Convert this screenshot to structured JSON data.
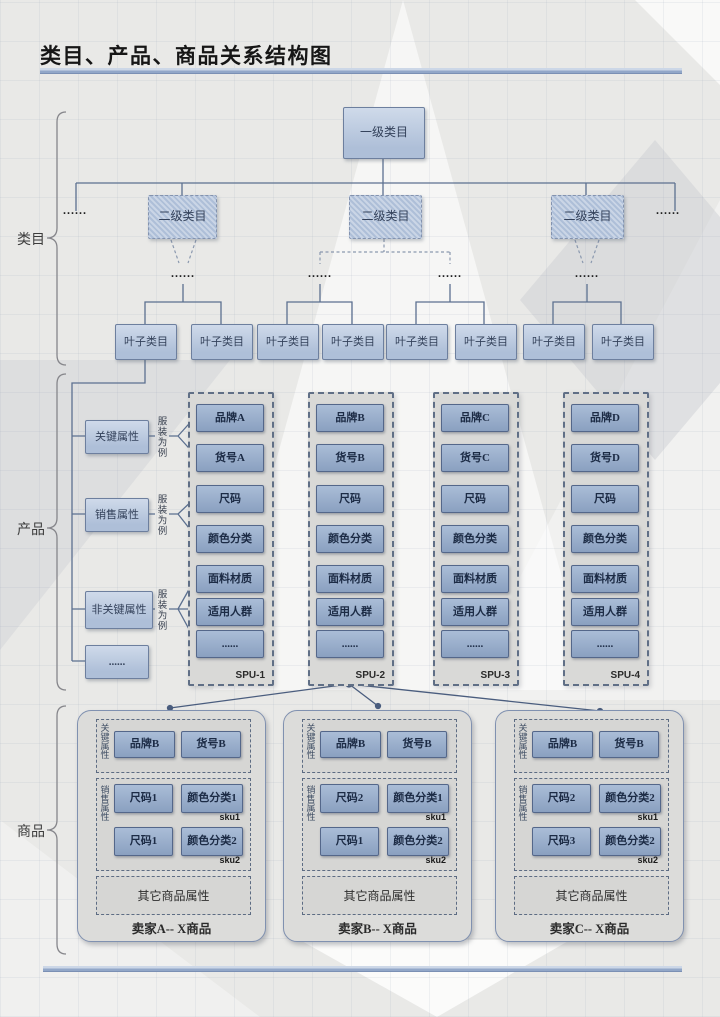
{
  "title": "类目、产品、商品关系结构图",
  "sections": {
    "category": {
      "label": "类目"
    },
    "product": {
      "label": "产品"
    },
    "goods": {
      "label": "商品"
    }
  },
  "category": {
    "root": "一级类目",
    "second_level": "二级类目",
    "leaf": "叶子类目",
    "ellipsis": "......"
  },
  "product": {
    "attributes": [
      {
        "label": "关键属性",
        "example": "服装为例"
      },
      {
        "label": "销售属性",
        "example": "服装为例"
      },
      {
        "label": "非关键属性",
        "example": "服装为例"
      },
      {
        "label": "......"
      }
    ],
    "spus": [
      {
        "name": "SPU-1",
        "items": [
          "品牌A",
          "货号A",
          "尺码",
          "颜色分类",
          "面料材质",
          "适用人群",
          "......"
        ]
      },
      {
        "name": "SPU-2",
        "items": [
          "品牌B",
          "货号B",
          "尺码",
          "颜色分类",
          "面料材质",
          "适用人群",
          "......"
        ]
      },
      {
        "name": "SPU-3",
        "items": [
          "品牌C",
          "货号C",
          "尺码",
          "颜色分类",
          "面料材质",
          "适用人群",
          "......"
        ]
      },
      {
        "name": "SPU-4",
        "items": [
          "品牌D",
          "货号D",
          "尺码",
          "颜色分类",
          "面料材质",
          "适用人群",
          "......"
        ]
      }
    ]
  },
  "goods": {
    "key_attr_label": "关键属性",
    "sales_attr_label": "销售属性",
    "sellers": [
      {
        "title": "卖家A-- X商品",
        "brand": "品牌B",
        "item_no": "货号B",
        "other": "其它商品属性",
        "skus": [
          {
            "size": "尺码1",
            "color": "颜色分类1",
            "label": "sku1"
          },
          {
            "size": "尺码1",
            "color": "颜色分类2",
            "label": "sku2"
          }
        ]
      },
      {
        "title": "卖家B-- X商品",
        "brand": "品牌B",
        "item_no": "货号B",
        "other": "其它商品属性",
        "skus": [
          {
            "size": "尺码2",
            "color": "颜色分类1",
            "label": "sku1"
          },
          {
            "size": "尺码1",
            "color": "颜色分类2",
            "label": "sku2"
          }
        ]
      },
      {
        "title": "卖家C-- X商品",
        "brand": "品牌B",
        "item_no": "货号B",
        "other": "其它商品属性",
        "skus": [
          {
            "size": "尺码2",
            "color": "颜色分类2",
            "label": "sku1"
          },
          {
            "size": "尺码3",
            "color": "颜色分类2",
            "label": "sku2"
          }
        ]
      }
    ]
  },
  "colors": {
    "background": "#e9e9e7",
    "accent_rule": "#92a7c8",
    "box_fill": "#b9c9de",
    "box_border": "#6d7f9e",
    "sku_fill": "#8aa0c0",
    "panel_fill": "#d9d9d7",
    "connector": "#5c7090"
  }
}
